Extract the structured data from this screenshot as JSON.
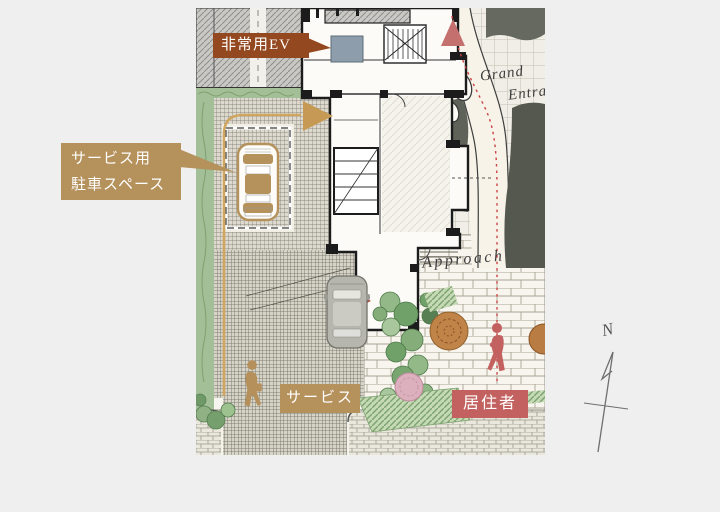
{
  "page": {
    "background": "#efefef"
  },
  "callouts": {
    "emergency_ev": {
      "text": "非常用EV",
      "bg": "#94481f",
      "text_color": "#ffffff"
    },
    "service_parking": {
      "line1": "サービス用",
      "line2": "駐車スペース",
      "bg": "#b5915c",
      "text_color": "#ffffff"
    },
    "service": {
      "text": "サービス",
      "bg": "#b5915c",
      "text_color": "#ffffff"
    },
    "resident": {
      "text": "居住者",
      "bg": "#c2615f",
      "text_color": "#ffffff"
    }
  },
  "annotations": {
    "grand_entrance_line1": "Grand",
    "grand_entrance_line2": "Entrance",
    "approach": "Approach",
    "compass_north": "N"
  },
  "colors": {
    "service_route": "#cfa55f",
    "service_arrow": "#c69a55",
    "resident_route": "#cb4343",
    "resident_arrow": "#c4706e",
    "ev_unit": "#8d9dab",
    "label_rust": "#94481f",
    "label_tan": "#b5915c",
    "label_rose": "#c2615f"
  },
  "icons": {
    "service_arrow": "right-triangle",
    "resident_arrow": "up-triangle",
    "north_compass": "hand-drawn-arrow",
    "service_person": "walking-person-silhouette",
    "resident_person": "walking-person-silhouette",
    "service_car": "car-top-view",
    "guest_car": "car-top-view"
  }
}
